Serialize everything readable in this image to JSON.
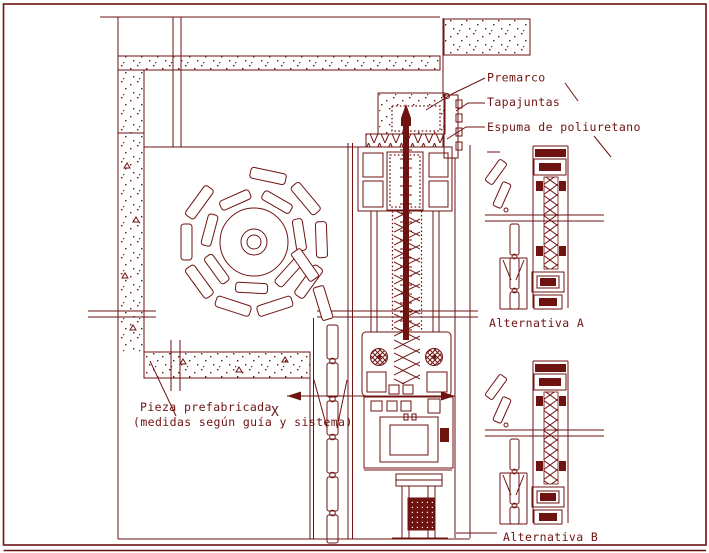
{
  "drawing": {
    "type": "cad-construction-detail",
    "labels": {
      "premarco": "Premarco",
      "tapajuntas": "Tapajuntas",
      "espuma": "Espuma de poliuretano",
      "alternativa_a": "Alternativa A",
      "alternativa_b": "Alternativa B",
      "pieza_line1": "Pieza prefabricada",
      "pieza_line2": "(medidas según guía y sistema)",
      "section_x": "X"
    },
    "colors": {
      "line": "#6e1310",
      "background": "#ffffff"
    }
  }
}
